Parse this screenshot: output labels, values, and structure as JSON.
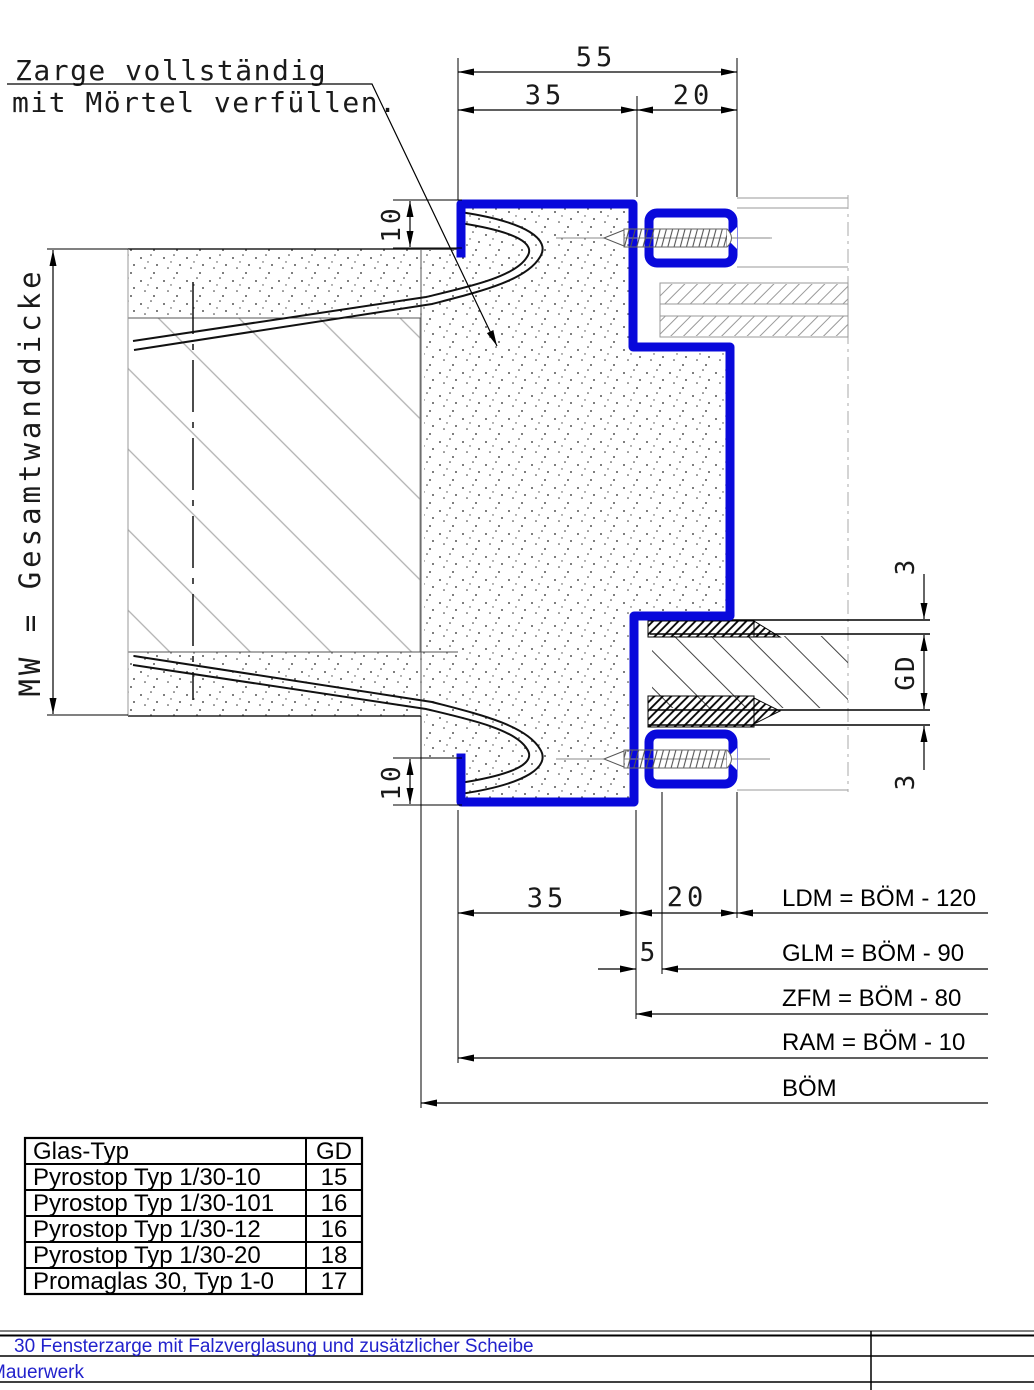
{
  "colors": {
    "frame_blue": "#0909db",
    "title_blue": "#2222cc",
    "line_black": "#000000",
    "hatch_gray": "#b0b0b0"
  },
  "annotation": {
    "line1": "Zarge vollständig",
    "line2": "mit Mörtel verfüllen."
  },
  "dimensions": {
    "top_total": "55",
    "top_left": "35",
    "top_right": "20",
    "flange_top": "10",
    "flange_bottom": "10",
    "wall_label": "MW = Gesamtwanddicke",
    "bottom_left": "35",
    "bottom_small": "5",
    "bottom_right": "20",
    "gap_top": "3",
    "glass_thickness": "GD",
    "gap_bottom": "3",
    "formulas": [
      "LDM = BÖM - 120",
      "GLM = BÖM - 90",
      "ZFM = BÖM - 80",
      "RAM = BÖM - 10",
      "BÖM"
    ]
  },
  "glass_table": {
    "headers": [
      "Glas-Typ",
      "GD"
    ],
    "rows": [
      [
        "Pyrostop Typ 1/30-10",
        "15"
      ],
      [
        "Pyrostop Typ 1/30-101",
        "16"
      ],
      [
        "Pyrostop Typ 1/30-12",
        "16"
      ],
      [
        "Pyrostop Typ 1/30-20",
        "18"
      ],
      [
        "Promaglas 30, Typ 1-0",
        "17"
      ]
    ]
  },
  "title_block": {
    "row1": "30 Fensterzarge mit Falzverglasung und zusätzlicher Scheibe",
    "row2": "Mauerwerk"
  }
}
